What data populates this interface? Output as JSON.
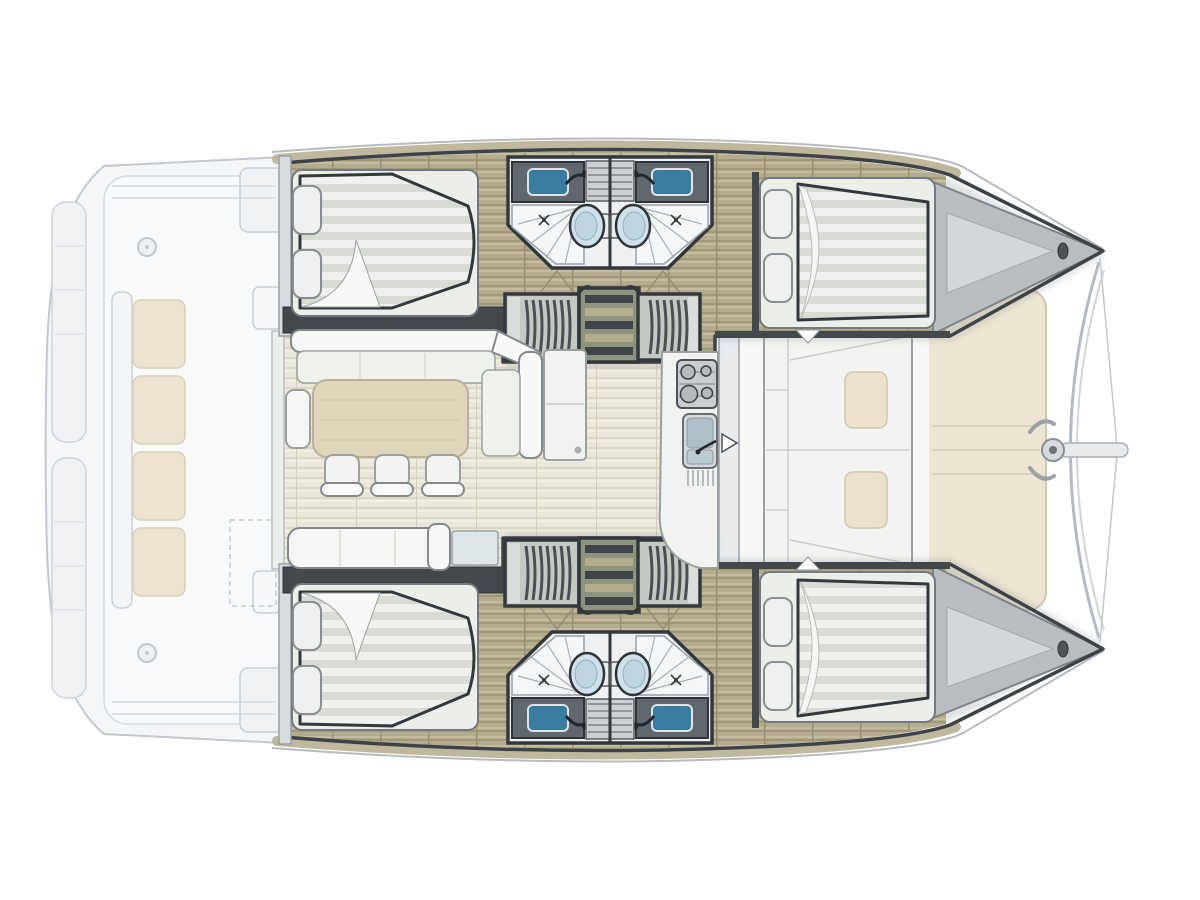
{
  "scene": {
    "type": "catamaran-floor-plan",
    "view": "top-down",
    "orientation": "bow-right-stern-left",
    "visible_text": []
  },
  "palette": {
    "background": "#ffffff",
    "ghost_outline": "#c3c8ce",
    "ghost_fill": "#f5f6f8",
    "hull_wall_dark": "#3d4247",
    "wood_floor": "#b3ac8e",
    "wood_floor_shadow": "#a09977",
    "salon_floor": "#eae6d9",
    "bed_stripe": "#d9dbd5",
    "furniture_white": "#f6f7f4",
    "furniture_outline": "#84898d",
    "cushion_beige": "#e9e1ca",
    "sunpad_cream": "#ece5d1",
    "counter_dark": "#60676d",
    "sink_blue": "#3a7ca0",
    "toilet_blue": "#d1e1e9",
    "locker_gray": "#c4c9c4",
    "locker_rib": "#4a4f53",
    "bow_deck_gray": "#b9bdc1",
    "bow_deck_inner": "#d4d7da",
    "table_beige": "#ded6bb"
  },
  "layout": {
    "stern_deck": {
      "features": [
        "transom-steps",
        "aft-bench",
        "bench-cushions",
        "side-consoles",
        "storage-dashed-outline",
        "deck-fittings"
      ]
    },
    "hulls": {
      "count": 2,
      "mirrored": true,
      "per_hull": {
        "aft_cabin": {
          "bed": "double-berth",
          "pillows": 2
        },
        "bathrooms": {
          "count": 2,
          "fixtures_each": [
            "washbasin-with-faucet",
            "toilet",
            "shower"
          ]
        },
        "wardrobes": 2,
        "companionway_stairs": 1,
        "forward_cabin": {
          "bed": "double-berth",
          "pillows": 2
        },
        "bow": {
          "features": [
            "anchor-locker",
            "bow-cleat"
          ]
        }
      }
    },
    "saloon": {
      "furniture": [
        "l-shaped-sofa",
        "dining-table",
        "dining-chairs",
        "side-bench",
        "settee",
        "cabinet",
        "cooler-panel"
      ],
      "dining_chairs": 3
    },
    "galley": {
      "fixtures": [
        "three-burner-stove",
        "double-sink-with-faucet",
        "drainer",
        "rounded-counter-end"
      ]
    },
    "forward_cockpit": {
      "furniture": [
        "lounge-seating",
        "seat-cushions"
      ],
      "beige_cushions": 2,
      "door_indicator": "arrow"
    },
    "bow_area": {
      "features": [
        "sunpad",
        "crossbeam",
        "bowsprit",
        "bridle-lines",
        "cleats"
      ]
    }
  }
}
